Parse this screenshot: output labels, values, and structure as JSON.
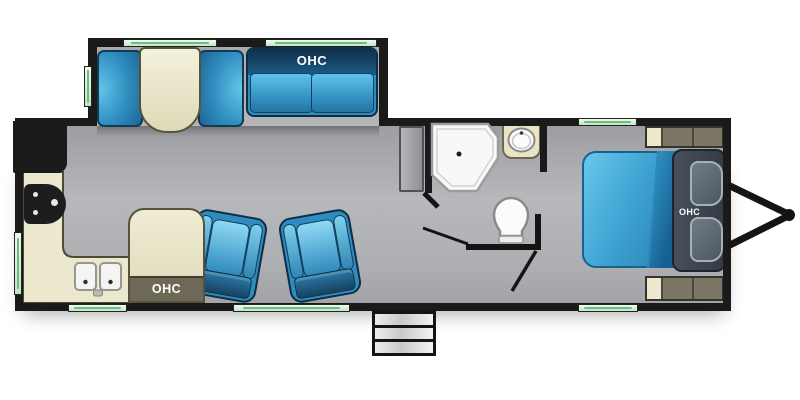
{
  "labels": {
    "sofa_ohc": "OHC",
    "kitchen_ohc": "OHC",
    "bedroom_ohc": "OHC"
  },
  "colors": {
    "wall_black": "#1a1a1a",
    "floor_gray": "#b6b8bb",
    "floor_gray_edge": "#9c9ea1",
    "furniture_blue": "#2f8cbe",
    "furniture_blue_light": "#5fc4ea",
    "sofa_back_navy": "#0f2f49",
    "counter_cream": "#ece8cd",
    "cabinet_olive": "#6e6957",
    "nightstand_olive": "#7c7666",
    "headboard_slate": "#46505a",
    "window_green": "#d8efda",
    "window_green_line": "#6fbc82",
    "fixture_white": "#f8f8f8"
  }
}
